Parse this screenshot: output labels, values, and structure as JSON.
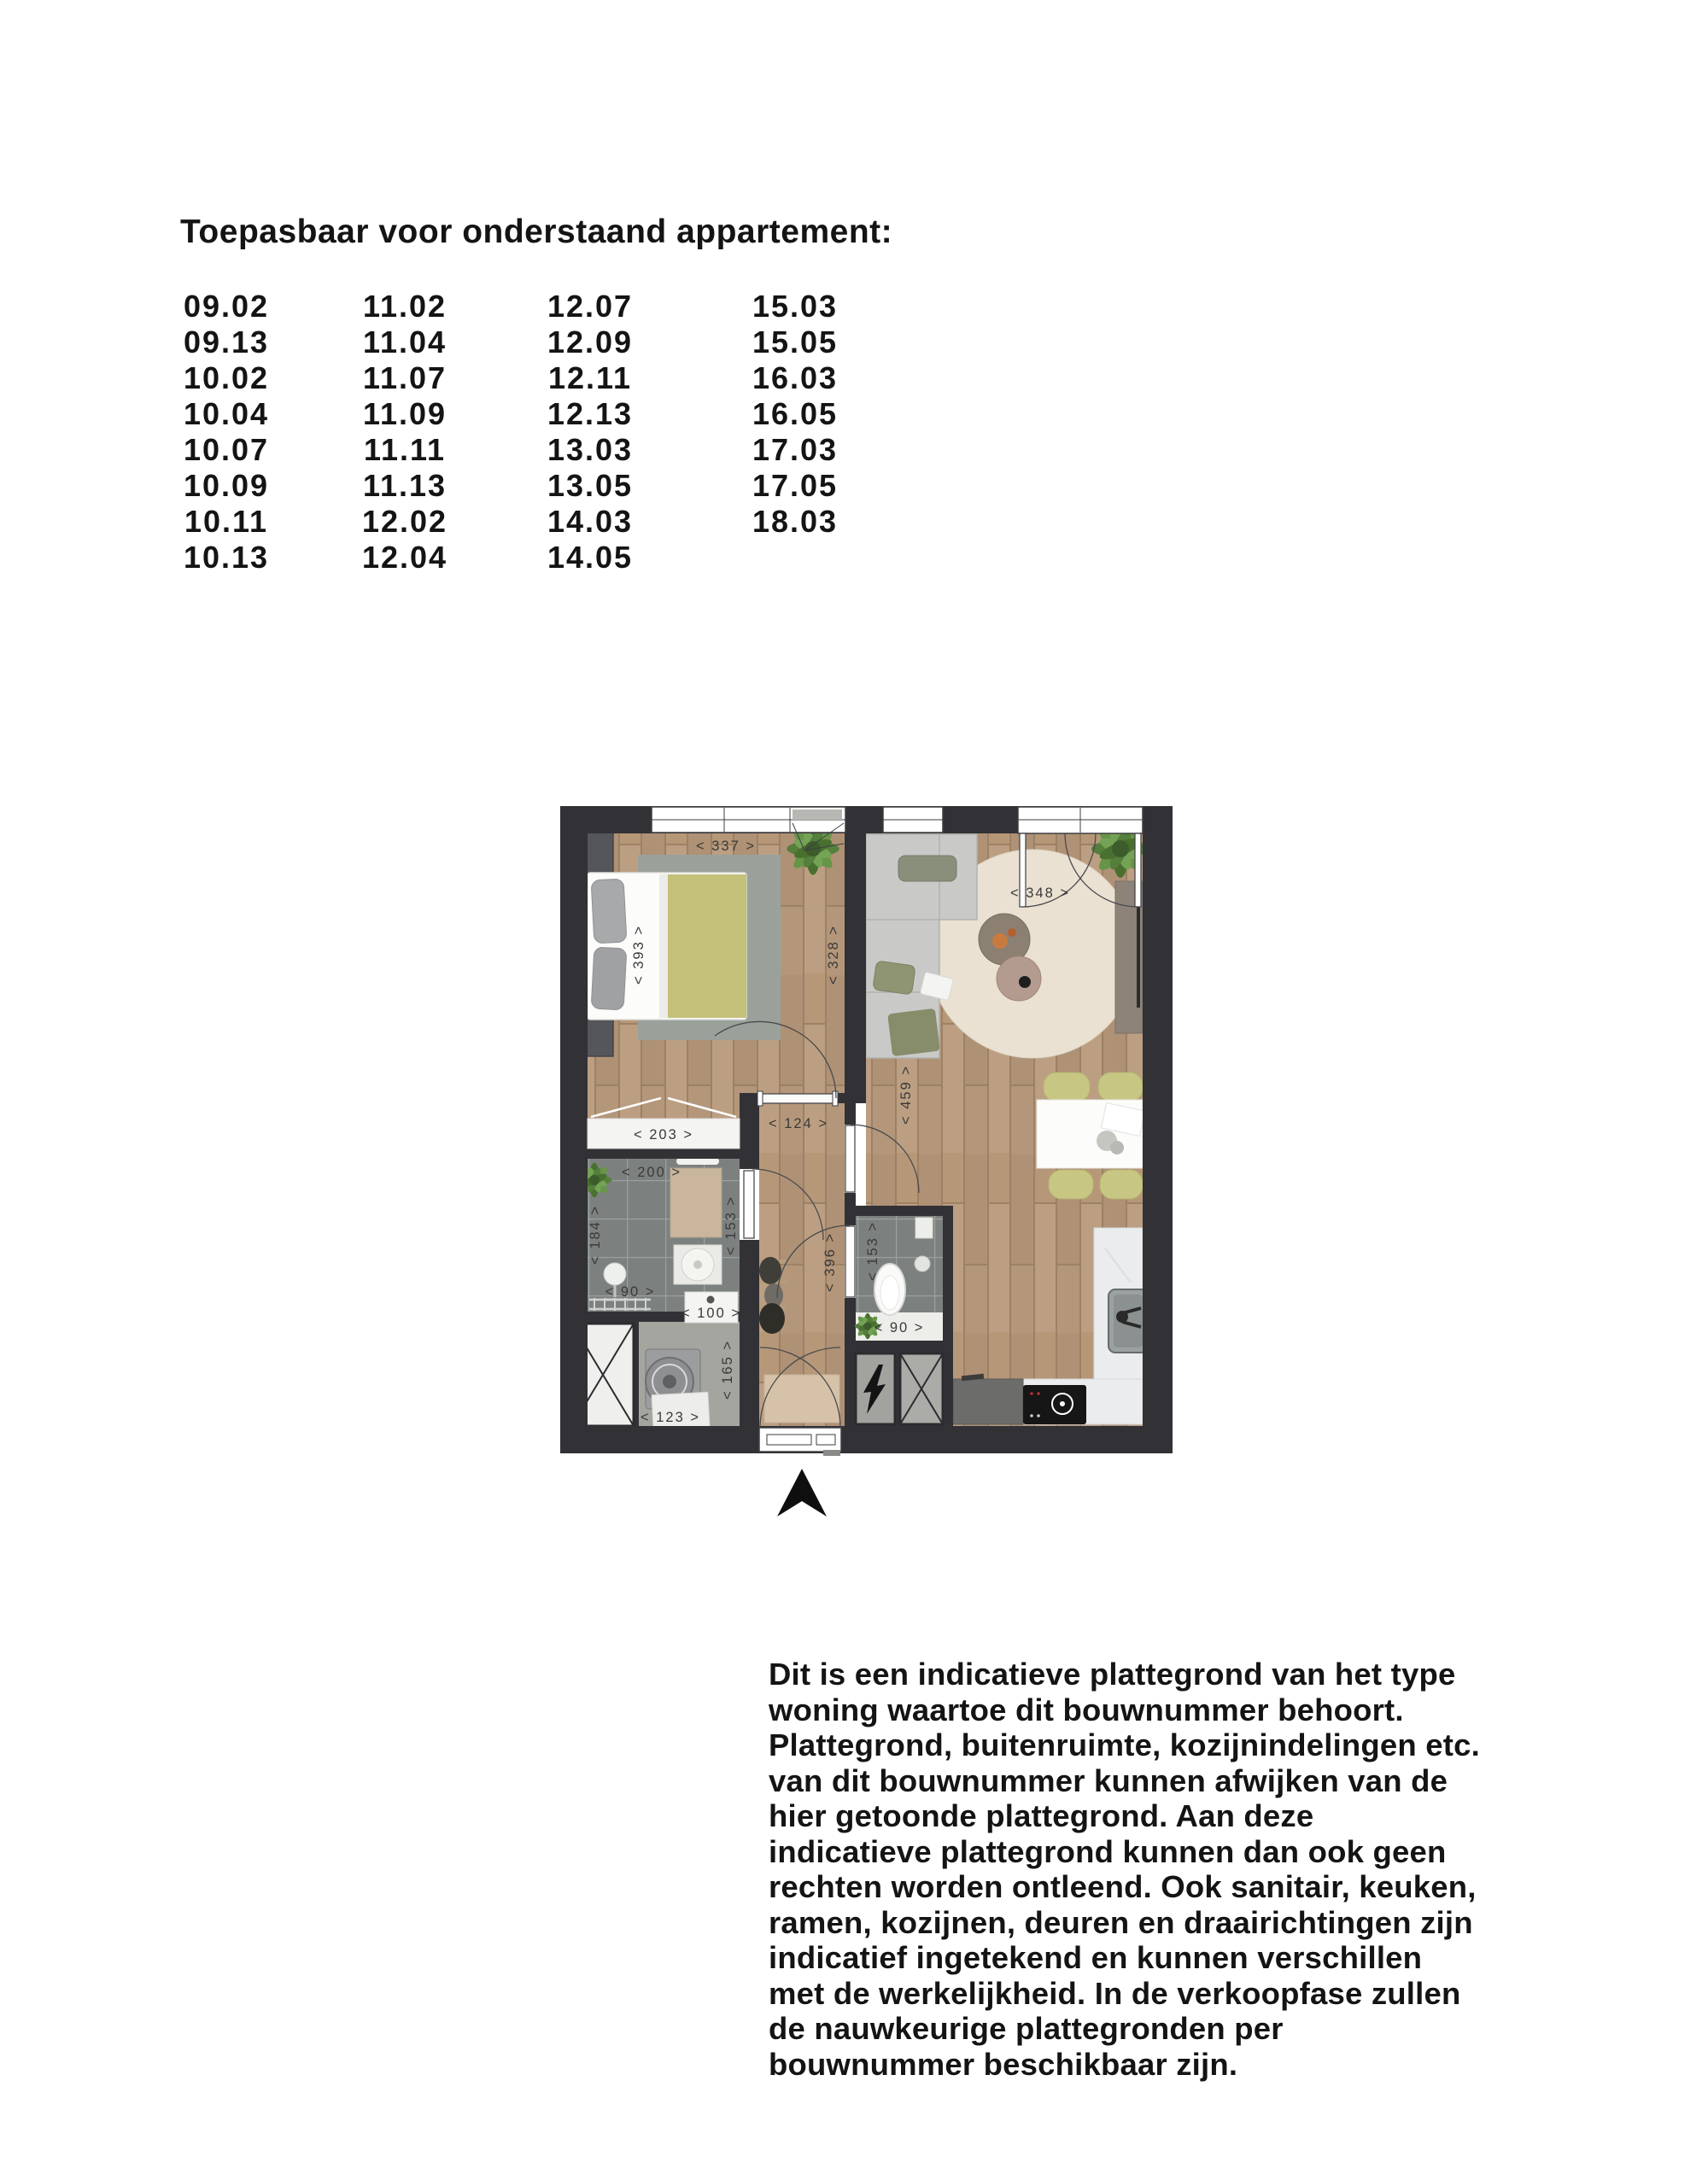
{
  "title": "Toepasbaar voor onderstaand appartement:",
  "apartments": {
    "columns": [
      [
        "09.02",
        "09.13",
        "10.02",
        "10.04",
        "10.07",
        "10.09",
        "10.11",
        "10.13"
      ],
      [
        "11.02",
        "11.04",
        "11.07",
        "11.09",
        "11.11",
        "11.13",
        "12.02",
        "12.04"
      ],
      [
        "12.07",
        "12.09",
        "12.11",
        "12.13",
        "13.03",
        "13.05",
        "14.03",
        "14.05"
      ],
      [
        "15.03",
        "15.05",
        "16.03",
        "16.05",
        "17.03",
        "17.05",
        "18.03"
      ]
    ]
  },
  "floorplan": {
    "compass": "north-arrow",
    "colors": {
      "wall": "#323135",
      "wood": "#b69878",
      "tile": "#7c817f",
      "concrete": "#a5a5a0",
      "marble": "#eaeced",
      "olive": "#c3c179",
      "living_rug": "#eae1d2",
      "bedroom_rug": "#9aa19b",
      "sofa": "#c9cac8"
    },
    "dims": {
      "bedroom_width": "< 337 >",
      "bedroom_depth": "< 393 >",
      "bedroom_living_wall": "< 328 >",
      "living_width": "< 348 >",
      "living_depth": "< 459 >",
      "hall_width": "< 124 >",
      "hall_depth": "< 396 >",
      "wardrobe_width": "< 203 >",
      "bath_width": "< 200 >",
      "bath_depth": "< 184 >",
      "bath_inner": "< 153 >",
      "bath_shower": "< 90 >",
      "storage_shelf": "< 100 >",
      "storage_depth": "< 165 >",
      "storage_width": "< 123 >",
      "wc_depth": "< 153 >",
      "wc_width": "< 90 >"
    }
  },
  "disclaimer": {
    "lines": [
      "Dit is een indicatieve plattegrond van het type",
      "woning waartoe dit bouwnummer behoort.",
      "Plattegrond, buitenruimte, kozijnindelingen etc.",
      "van dit bouwnummer kunnen afwijken van de",
      "hier getoonde plattegrond. Aan deze",
      "indicatieve plattegrond kunnen dan ook geen",
      "rechten worden ontleend. Ook sanitair, keuken,",
      "ramen, kozijnen, deuren en draairichtingen zijn",
      "indicatief ingetekend en kunnen verschillen",
      "met de werkelijkheid. In de verkoopfase zullen",
      "de nauwkeurige plattegronden per",
      "bouwnummer beschikbaar zijn."
    ]
  }
}
